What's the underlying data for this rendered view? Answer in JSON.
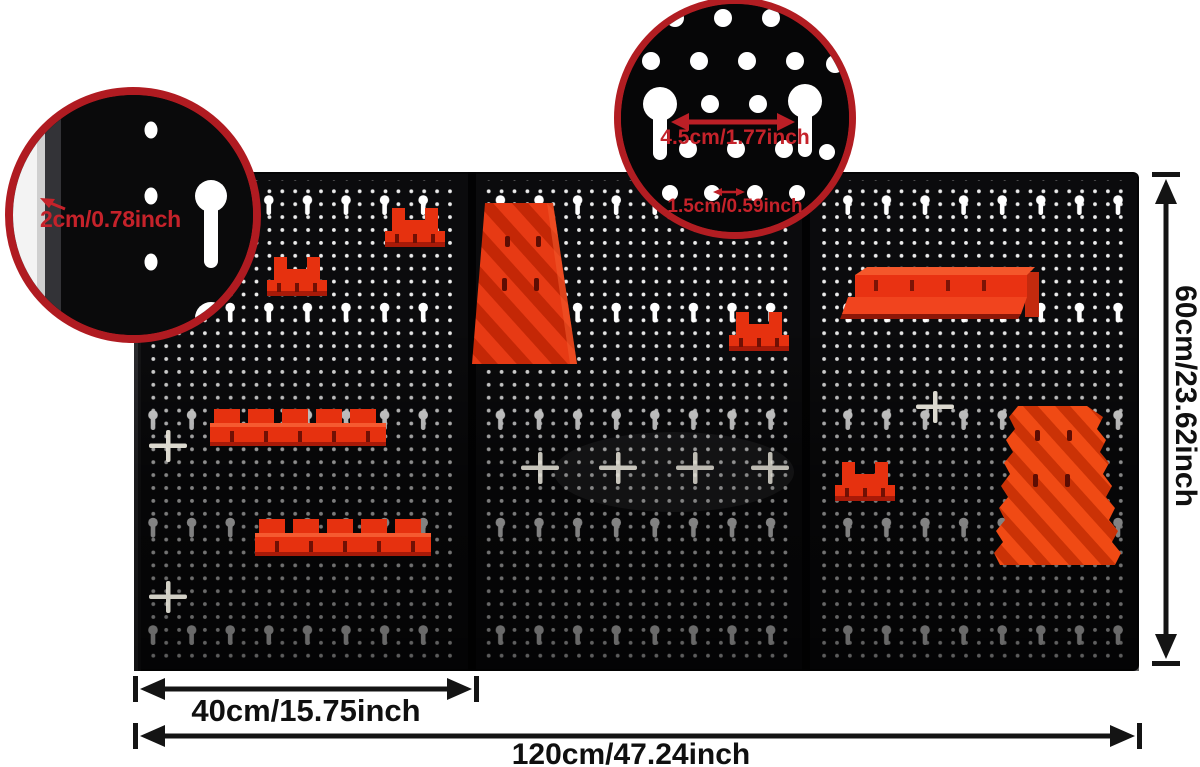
{
  "callout_edge": {
    "label": "2cm/0.78inch"
  },
  "callout_holes": {
    "keyhole_spacing": "4.5cm/1.77inch",
    "dot_spacing": "1.5cm/0.59inch"
  },
  "dimensions": {
    "panel_width": "40cm/15.75inch",
    "total_width": "120cm/47.24inch",
    "height": "60cm/23.62inch"
  },
  "colors": {
    "background": "#ffffff",
    "board_black": "#0b0b0d",
    "accessory_red": "#e6310f",
    "accessory_orange": "#f04a14",
    "callout_ring_red": "#b01b21",
    "annotation_red": "#c5222a",
    "dimension_black": "#101010",
    "hole_white": "#ffffff"
  }
}
